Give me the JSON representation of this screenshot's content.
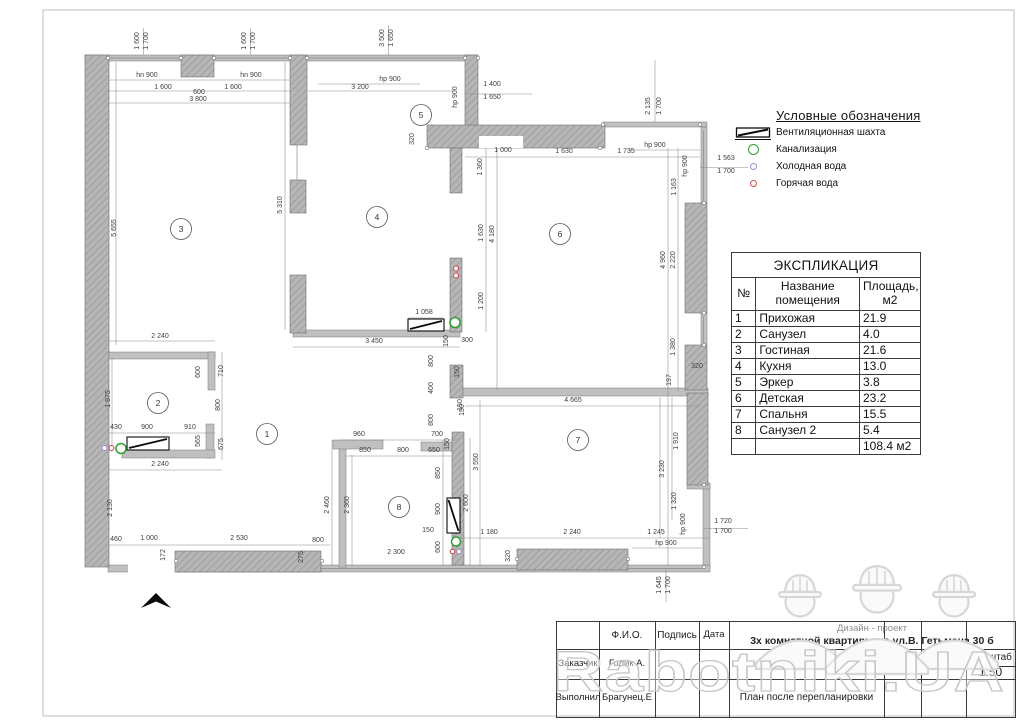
{
  "legend": {
    "title": "Условные обозначения",
    "items": [
      {
        "icon": "vent-shaft-symbol",
        "label": "Вентиляционная шахта"
      },
      {
        "icon": "sewage-circle",
        "label": "Канализация",
        "color": "#2f9e2f"
      },
      {
        "icon": "cold-water-circle",
        "label": "Холодная вода",
        "color": "#9a8fc5"
      },
      {
        "icon": "hot-water-circle",
        "label": "Горячая вода",
        "color": "#cc4d4d"
      }
    ]
  },
  "explication": {
    "title": "ЭКСПЛИКАЦИЯ",
    "columns": [
      "№",
      "Название\nпомещения",
      "Площадь,\nм2"
    ],
    "rows": [
      [
        "1",
        "Прихожая",
        "21.9"
      ],
      [
        "2",
        "Санузел",
        "4.0"
      ],
      [
        "3",
        "Гостиная",
        "21.6"
      ],
      [
        "4",
        "Кухня",
        "13.0"
      ],
      [
        "5",
        "Эркер",
        "3.8"
      ],
      [
        "6",
        "Детская",
        "23.2"
      ],
      [
        "7",
        "Спальня",
        "15.5"
      ],
      [
        "8",
        "Санузел 2",
        "5.4"
      ]
    ],
    "total": "108.4 м2"
  },
  "title_block": {
    "fio_header": "Ф.И.О.",
    "signature_header": "Подпись",
    "date_header": "Дата",
    "customer_label": "Заказчик",
    "customer_name": "Голик А.",
    "executor_label": "Выполнил",
    "executor_name": "Брагунец.Е",
    "project_line1": "Дизайн - проект",
    "project_line2": "3х комнатной квартиры по ул.В. Гетьмана 30 б",
    "sheet_label": "Лист",
    "sheets_label": "Листов",
    "scale_label": "Масштаб",
    "scale_value": "1:50",
    "drawing_title": "План после перепланировки"
  },
  "watermark": {
    "text": "Rabotniki.UA"
  },
  "plan": {
    "rooms": [
      {
        "n": "1",
        "x": 267,
        "y": 434
      },
      {
        "n": "2",
        "x": 158,
        "y": 403
      },
      {
        "n": "3",
        "x": 181,
        "y": 229
      },
      {
        "n": "4",
        "x": 377,
        "y": 217
      },
      {
        "n": "5",
        "x": 421,
        "y": 115
      },
      {
        "n": "6",
        "x": 560,
        "y": 234
      },
      {
        "n": "7",
        "x": 578,
        "y": 440
      },
      {
        "n": "8",
        "x": 399,
        "y": 507
      }
    ],
    "dim_labels": [
      [
        "1 600",
        139,
        41,
        "v"
      ],
      [
        "1 700",
        148,
        41,
        "v"
      ],
      [
        "1 600",
        246,
        41,
        "v"
      ],
      [
        "1 700",
        255,
        41,
        "v"
      ],
      [
        "3 500",
        384,
        38,
        "v"
      ],
      [
        "1 650",
        393,
        38,
        "v"
      ],
      [
        "hn 900",
        147,
        77
      ],
      [
        "hn 900",
        251,
        77
      ],
      [
        "1 600",
        163,
        89
      ],
      [
        "600",
        199,
        94
      ],
      [
        "1 600",
        233,
        89
      ],
      [
        "3 800",
        198,
        101
      ],
      [
        "hp 900",
        390,
        81
      ],
      [
        "3 200",
        360,
        89
      ],
      [
        "hp 900",
        457,
        97,
        "v"
      ],
      [
        "1 400",
        492,
        86
      ],
      [
        "1 650",
        492,
        99
      ],
      [
        "2 135",
        650,
        106,
        "v"
      ],
      [
        "1 700",
        661,
        106,
        "v"
      ],
      [
        "1 563",
        726,
        160
      ],
      [
        "1 700",
        726,
        173
      ],
      [
        "320",
        414,
        139,
        "v"
      ],
      [
        "1 000",
        503,
        152
      ],
      [
        "1 630",
        564,
        153
      ],
      [
        "1 735",
        626,
        153
      ],
      [
        "hp 900",
        655,
        147
      ],
      [
        "hp 900",
        687,
        166,
        "v"
      ],
      [
        "1 163",
        676,
        187,
        "v"
      ],
      [
        "1 360",
        482,
        167,
        "v"
      ],
      [
        "1 630",
        483,
        233,
        "v"
      ],
      [
        "4 180",
        494,
        234,
        "v"
      ],
      [
        "1 200",
        483,
        301,
        "v"
      ],
      [
        "4 960",
        665,
        260,
        "v"
      ],
      [
        "2 220",
        675,
        260,
        "v"
      ],
      [
        "1 380",
        675,
        347,
        "v"
      ],
      [
        "320",
        697,
        368
      ],
      [
        "197",
        671,
        380,
        "v"
      ],
      [
        "5 655",
        116,
        228,
        "v"
      ],
      [
        "5 310",
        282,
        205,
        "v"
      ],
      [
        "2 240",
        160,
        338
      ],
      [
        "600",
        200,
        372,
        "v"
      ],
      [
        "710",
        223,
        371,
        "v"
      ],
      [
        "1 975",
        110,
        399,
        "v"
      ],
      [
        "800",
        220,
        405,
        "v"
      ],
      [
        "430",
        116,
        429
      ],
      [
        "900",
        147,
        429
      ],
      [
        "910",
        190,
        429
      ],
      [
        "565",
        200,
        441,
        "v"
      ],
      [
        "675",
        223,
        444,
        "v"
      ],
      [
        "2 240",
        160,
        466
      ],
      [
        "1 058",
        424,
        314
      ],
      [
        "3 450",
        374,
        343
      ],
      [
        "300",
        467,
        342
      ],
      [
        "150",
        448,
        341,
        "v"
      ],
      [
        "800",
        433,
        361,
        "v"
      ],
      [
        "150",
        459,
        372,
        "v"
      ],
      [
        "400",
        433,
        388,
        "v"
      ],
      [
        "150",
        462,
        405,
        "v"
      ],
      [
        "800",
        433,
        420,
        "v"
      ],
      [
        "4 665",
        573,
        402
      ],
      [
        "150",
        464,
        410,
        "v"
      ],
      [
        "960",
        359,
        436
      ],
      [
        "700",
        437,
        436
      ],
      [
        "150",
        449,
        444,
        "v"
      ],
      [
        "850",
        365,
        452
      ],
      [
        "800",
        403,
        452
      ],
      [
        "650",
        434,
        452
      ],
      [
        "850",
        440,
        473,
        "v"
      ],
      [
        "2 460",
        329,
        505,
        "v"
      ],
      [
        "2 360",
        349,
        505,
        "v"
      ],
      [
        "900",
        440,
        509,
        "v"
      ],
      [
        "3 550",
        478,
        462,
        "v"
      ],
      [
        "2 600",
        468,
        503,
        "v"
      ],
      [
        "1 910",
        678,
        441,
        "v"
      ],
      [
        "3 230",
        664,
        469,
        "v"
      ],
      [
        "1 320",
        676,
        501,
        "v"
      ],
      [
        "hp 900",
        685,
        524,
        "v"
      ],
      [
        "150",
        428,
        532
      ],
      [
        "600",
        440,
        547,
        "v"
      ],
      [
        "2 300",
        396,
        554
      ],
      [
        "800",
        318,
        542
      ],
      [
        "2 130",
        112,
        508,
        "v"
      ],
      [
        "460",
        116,
        541
      ],
      [
        "1 000",
        149,
        540
      ],
      [
        "2 530",
        239,
        540
      ],
      [
        "172",
        165,
        555,
        "v"
      ],
      [
        "275",
        303,
        557,
        "v"
      ],
      [
        "1 180",
        489,
        534
      ],
      [
        "2 240",
        572,
        534
      ],
      [
        "1 245",
        656,
        534
      ],
      [
        "hp 900",
        666,
        545
      ],
      [
        "320",
        510,
        556,
        "v"
      ],
      [
        "1 720",
        723,
        523
      ],
      [
        "1 700",
        723,
        533
      ],
      [
        "1 645",
        661,
        585,
        "v"
      ],
      [
        "1 700",
        670,
        585,
        "v"
      ]
    ],
    "symbols": [
      {
        "x": 104.5,
        "y": 448,
        "r": 2.5,
        "color": "#9a8fc5"
      },
      {
        "x": 111.5,
        "y": 448,
        "r": 2.5,
        "color": "#cc4d4d"
      },
      {
        "x": 121,
        "y": 448.5,
        "r": 5,
        "color": "#2f9e2f"
      },
      {
        "x": 456,
        "y": 268.5,
        "r": 2.5,
        "color": "#cc4d4d"
      },
      {
        "x": 456,
        "y": 275.5,
        "r": 2.5,
        "color": "#cc4d4d"
      },
      {
        "x": 455,
        "y": 322.5,
        "r": 5,
        "color": "#2f9e2f"
      },
      {
        "x": 456,
        "y": 541.5,
        "r": 4.5,
        "color": "#2f9e2f"
      },
      {
        "x": 452.5,
        "y": 551.5,
        "r": 2.3,
        "color": "#cc4d4d"
      },
      {
        "x": 459,
        "y": 551.5,
        "r": 2.3,
        "color": "#9a8fc5"
      }
    ],
    "shafts": [
      {
        "x": 127,
        "y": 437,
        "w": 42,
        "h": 13
      },
      {
        "x": 408,
        "y": 319,
        "w": 36,
        "h": 12
      },
      {
        "x": 447,
        "y": 498,
        "w": 13,
        "h": 35
      }
    ]
  }
}
